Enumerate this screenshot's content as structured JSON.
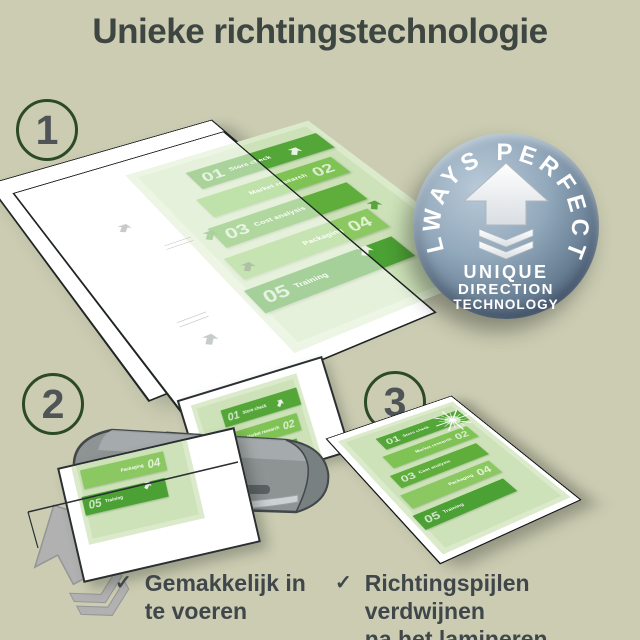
{
  "title": "Unieke richtingstechnologie",
  "steps": [
    {
      "number": "1"
    },
    {
      "number": "2"
    },
    {
      "number": "3"
    }
  ],
  "badge": {
    "arc_text": "ALWAYS PERFECT!",
    "lines": [
      "UNIQUE",
      "DIRECTION",
      "TECHNOLOGY"
    ]
  },
  "doc": {
    "corner_label": "Launch",
    "items": [
      {
        "num": "01",
        "label": "Store check"
      },
      {
        "num": "02",
        "label": "Market research"
      },
      {
        "num": "03",
        "label": "Cost analysis"
      },
      {
        "num": "04",
        "label": "Packaging"
      },
      {
        "num": "05",
        "label": "Training"
      }
    ]
  },
  "benefits": [
    {
      "check": "✓",
      "line1": "Gemakkelijk in",
      "line2": "te voeren"
    },
    {
      "check": "✓",
      "line1": "Richtingspijlen verdwijnen",
      "line2": "na het lamineren"
    }
  ],
  "colors": {
    "background": "#cbccb2",
    "title_text": "#3e4642",
    "step_circle_border": "#2c4a27",
    "step_number": "#4f5456",
    "benefit_text": "#40474a",
    "doc_page": "#cde2b8",
    "doc_green_dark": "#53a637",
    "doc_green_mid": "#7fc355",
    "badge_blue": "#7a8fa3",
    "machine_gray": "#8e9394"
  }
}
